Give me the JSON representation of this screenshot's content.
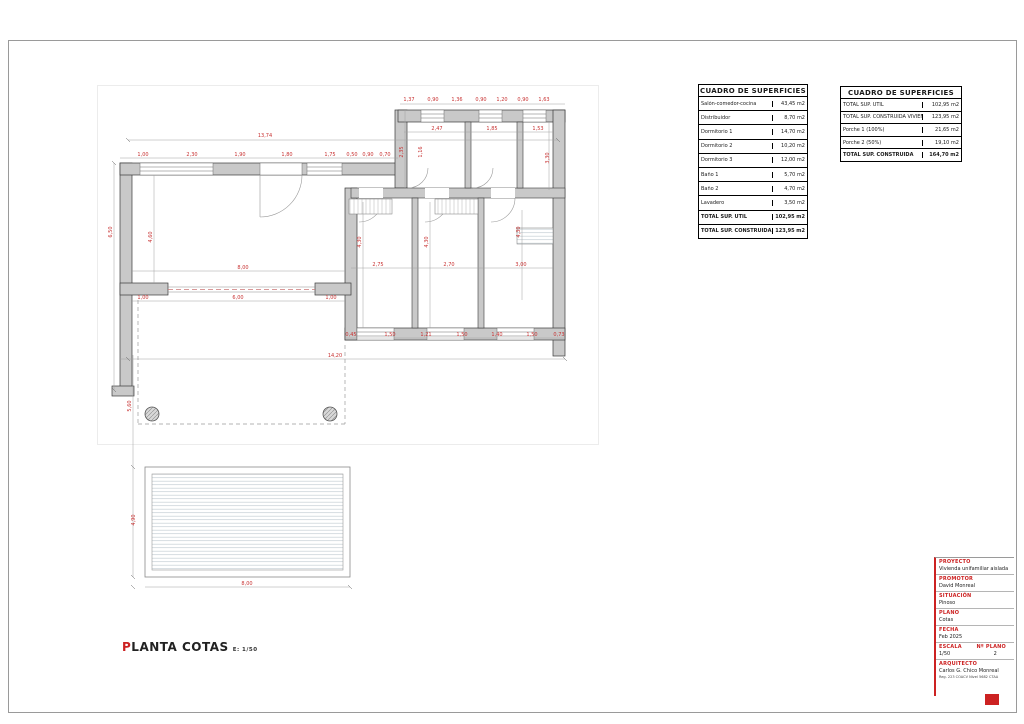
{
  "colors": {
    "accent_red": "#cc2222",
    "dim_red": "#c83232",
    "wall_gray": "#c9c9c9"
  },
  "caption": {
    "first_letter": "P",
    "rest": "LANTA COTAS",
    "scale": "E: 1/50"
  },
  "tables": [
    {
      "title": "CUADRO DE SUPERFICIES",
      "rows": [
        {
          "label": "Salón-comedor-cocina",
          "value": "43,45 m2"
        },
        {
          "label": "Distribuidor",
          "value": "8,70 m2"
        },
        {
          "label": "Dormitorio 1",
          "value": "14,70 m2"
        },
        {
          "label": "Dormitorio 2",
          "value": "10,20 m2"
        },
        {
          "label": "Dormitorio 3",
          "value": "12,00 m2"
        },
        {
          "label": "Baño 1",
          "value": "5,70 m2"
        },
        {
          "label": "Baño 2",
          "value": "4,70 m2"
        },
        {
          "label": "Lavadero",
          "value": "3,50 m2"
        },
        {
          "label": "TOTAL SUP. ÚTIL",
          "value": "102,95 m2",
          "strong": true
        },
        {
          "label": "TOTAL SUP. CONSTRUIDA VIVIENDA",
          "value": "123,95 m2",
          "strong": true
        }
      ]
    },
    {
      "title": "CUADRO DE SUPERFICIES",
      "rows": [
        {
          "label": "TOTAL SUP. ÚTIL",
          "value": "102,95 m2"
        },
        {
          "label": "TOTAL SUP. CONSTRUIDA VIVIENDA",
          "value": "123,95 m2"
        },
        {
          "label": "Porche 1 (100%)",
          "value": "21,65 m2"
        },
        {
          "label": "Porche 2 (50%)",
          "value": "19,10 m2"
        },
        {
          "label": "TOTAL SUP. CONSTRUIDA",
          "value": "164,70 m2",
          "strong": true
        }
      ]
    }
  ],
  "title_block": {
    "fields": [
      {
        "label": "PROYECTO",
        "value": "Vivienda unifamiliar aislada"
      },
      {
        "label": "PROMOTOR",
        "value": "David Monreal"
      },
      {
        "label": "SITUACIÓN",
        "value": "Pinoso"
      },
      {
        "label": "PLANO",
        "value": "Cotas"
      },
      {
        "label": "FECHA",
        "value": "Feb 2025"
      }
    ],
    "escala_label": "ESCALA",
    "escala_value": "1/50",
    "num_label": "Nº PLANO",
    "num_value": "2",
    "arquitecto_label": "ARQUITECTO",
    "arquitecto_value": "Carlos G. Chico Monreal",
    "arquitecto_reg": "Reg. 223 COACV Nivel 5682 CTAA"
  },
  "plan": {
    "dim_color": "#c83232",
    "dims": [
      {
        "x": 265,
        "y": 137,
        "t": "13,74"
      },
      {
        "x": 143,
        "y": 156,
        "t": "1,00"
      },
      {
        "x": 192,
        "y": 156,
        "t": "2,30"
      },
      {
        "x": 240,
        "y": 156,
        "t": "1,90"
      },
      {
        "x": 287,
        "y": 156,
        "t": "1,80"
      },
      {
        "x": 330,
        "y": 156,
        "t": "1,75"
      },
      {
        "x": 352,
        "y": 156,
        "t": "0,50"
      },
      {
        "x": 368,
        "y": 156,
        "t": "0,90"
      },
      {
        "x": 385,
        "y": 156,
        "t": "0,70"
      },
      {
        "x": 403,
        "y": 152,
        "t": "2,35",
        "v": true
      },
      {
        "x": 409,
        "y": 101,
        "t": "1,37"
      },
      {
        "x": 433,
        "y": 101,
        "t": "0,90"
      },
      {
        "x": 457,
        "y": 101,
        "t": "1,36"
      },
      {
        "x": 481,
        "y": 101,
        "t": "0,90"
      },
      {
        "x": 502,
        "y": 101,
        "t": "1,20"
      },
      {
        "x": 523,
        "y": 101,
        "t": "0,90"
      },
      {
        "x": 544,
        "y": 101,
        "t": "1,63"
      },
      {
        "x": 437,
        "y": 130,
        "t": "2,47"
      },
      {
        "x": 492,
        "y": 130,
        "t": "1,85"
      },
      {
        "x": 538,
        "y": 130,
        "t": "1,53"
      },
      {
        "x": 422,
        "y": 152,
        "t": "1,16",
        "v": true
      },
      {
        "x": 549,
        "y": 158,
        "t": "3,30",
        "v": true
      },
      {
        "x": 112,
        "y": 232,
        "t": "6,50",
        "v": true
      },
      {
        "x": 152,
        "y": 237,
        "t": "4,60",
        "v": true
      },
      {
        "x": 243,
        "y": 269,
        "t": "8,00"
      },
      {
        "x": 238,
        "y": 299,
        "t": "6,00"
      },
      {
        "x": 143,
        "y": 299,
        "t": "1,00"
      },
      {
        "x": 331,
        "y": 299,
        "t": "1,00"
      },
      {
        "x": 378,
        "y": 266,
        "t": "2,75"
      },
      {
        "x": 449,
        "y": 266,
        "t": "2,70"
      },
      {
        "x": 521,
        "y": 266,
        "t": "3,00"
      },
      {
        "x": 361,
        "y": 242,
        "t": "4,30",
        "v": true
      },
      {
        "x": 428,
        "y": 242,
        "t": "4,30",
        "v": true
      },
      {
        "x": 520,
        "y": 232,
        "t": "4,30",
        "v": true
      },
      {
        "x": 351,
        "y": 336,
        "t": "0,45"
      },
      {
        "x": 390,
        "y": 336,
        "t": "1,50"
      },
      {
        "x": 426,
        "y": 336,
        "t": "1,21"
      },
      {
        "x": 462,
        "y": 336,
        "t": "1,50"
      },
      {
        "x": 497,
        "y": 336,
        "t": "1,40"
      },
      {
        "x": 532,
        "y": 336,
        "t": "1,50"
      },
      {
        "x": 559,
        "y": 336,
        "t": "0,73"
      },
      {
        "x": 335,
        "y": 357,
        "t": "14,20"
      },
      {
        "x": 131,
        "y": 406,
        "t": "5,60",
        "v": true
      },
      {
        "x": 135,
        "y": 520,
        "t": "4,90",
        "v": true
      },
      {
        "x": 247,
        "y": 585,
        "t": "8,00"
      }
    ]
  }
}
